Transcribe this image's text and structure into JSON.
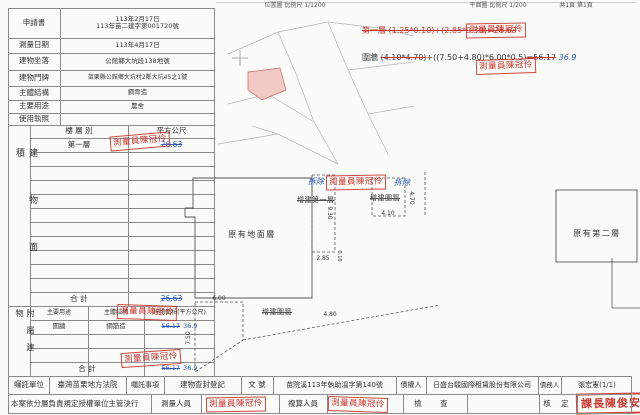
{
  "page": {
    "location_map_title": "位置圖 比例尺 1/1200",
    "plan_title": "平面圖 比例尺 1/200",
    "page_no": "共1頁 第1頁"
  },
  "info": {
    "application_label": "申請書",
    "application_line1": "113年2月17日",
    "application_line2": "113年苗二建字第001720號",
    "survey_date_label": "測量日期",
    "survey_date": "113年4月17日",
    "site_label": "建物坐落",
    "site": "公館鄉大坑段138地號",
    "address_label": "建物門牌",
    "address": "苗栗縣公館鄉大坑村2鄰大坑45之1號",
    "structure_label": "主體結構",
    "structure": "鋼骨造",
    "use_label": "主要用途",
    "use": "農舍",
    "license_label": "使用執照",
    "license": ""
  },
  "floor_table": {
    "side_label": "建物面積",
    "col_floor": "樓 層 別",
    "col_area": "平方公尺",
    "row_floor": "第一層",
    "row_area": "26.63",
    "total_label": "合 計",
    "total_area": "26.63"
  },
  "annex_table": {
    "side_label": "附屬建物",
    "col_use": "主要用途",
    "col_structure": "主體結構",
    "col_area": "建物面積(平方公尺)",
    "row_use": "圍牆",
    "row_structure": "鋼筋造",
    "row_area": "56.17",
    "row_area_revised": "36.9",
    "total_label": "合 計",
    "total_area": "56.17",
    "total_area_revised": "36.9"
  },
  "calc": {
    "line1": "第一層 (1.25*0.10)+(2.85*9.30)=26.63",
    "line2_prefix": "圍牆 ",
    "line2_struck1": "(4.10*4.70)",
    "line2_mid": "+((7.50+4.80)*6.00*0.5)",
    "line2_struck2": "=56.17",
    "line2_revised": "36.9"
  },
  "plan": {
    "ground_label": "原有地面層",
    "ext_first_label": "增建第一層",
    "ext_wall_label": "增建圍牆",
    "ext_wall_bottom_label": "增建圍牆",
    "second_label": "原有第二層",
    "demolish_note": "拆除",
    "dims": {
      "strip_h": "9.30",
      "strip_w": "2.85",
      "sliver": "0.10",
      "wall_w": "4.10",
      "wall_h": "4.70",
      "trap_top": "6.00",
      "trap_left": "7.50",
      "trap_right": "4.80"
    }
  },
  "stamps": {
    "surveyor": "測量員陳冠伶",
    "chief": "課長陳俊安"
  },
  "footer": {
    "entrust_unit_label": "囑託單位",
    "entrust_unit": "臺灣苗栗地方法院",
    "entrust_item_label": "囑託事項",
    "entrust_item": "建物查封登記",
    "doc_no_label": "文 號",
    "doc_no": "苗院溪113年執助溫字第140號",
    "creditor_label": "債權人",
    "creditor": "日盛台駿國際租賃股份有限公司",
    "debtor_label": "債務人",
    "debtor": "張宏憲(1/1)",
    "authorization": "本案依分層負責規定授權單位主管決行",
    "surveyor_label": "測量人員",
    "reviewer_label": "複算人員",
    "check_label": "檢 查",
    "approve_label": "核 定"
  },
  "colors": {
    "stamp_red": "#c2352b",
    "note_blue": "#2757b8",
    "parcel_pink": "#f2c9c5",
    "line_gray": "#8a8a8a"
  }
}
